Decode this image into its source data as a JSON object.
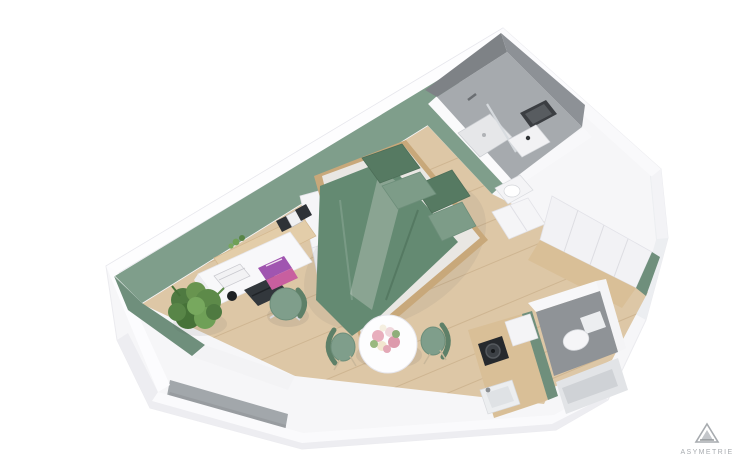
{
  "scene": {
    "type": "3d-floor-plan-render",
    "view": "isometric top-down",
    "description": "3D rendering of a studio apartment floor plan on a white background",
    "rooms": [
      {
        "name": "living-bedroom",
        "features": [
          "double bed with green bedding and four pillows",
          "white wardrobe cubes",
          "wall shelf with binders, clock and plant",
          "white desk with laptop, magazines and books",
          "green office chair",
          "floor plant",
          "round white dining table with flower bouquet",
          "two green dining chairs"
        ]
      },
      {
        "name": "bathroom",
        "features": [
          "gray concrete walls",
          "walk-in shower with glass partition",
          "washbasin with black-framed mirror",
          "toilet"
        ]
      },
      {
        "name": "separate-wc",
        "features": [
          "gray tiled floor",
          "white toilet"
        ]
      },
      {
        "name": "kitchenette",
        "features": [
          "wooden counter",
          "black cooktop",
          "inset sink with faucet",
          "white cabinet column",
          "green accent wall"
        ]
      },
      {
        "name": "entry-hall",
        "features": [
          "built-in white closets",
          "wood flooring",
          "green accent edges"
        ]
      }
    ]
  },
  "brand": {
    "name": "ASYMETRIE",
    "logo": "triangle-a-logo"
  },
  "palette": {
    "background": "#ffffff",
    "wall_white": "#f6f6f8",
    "wall_top": "#fdfdfe",
    "wall_shade": "#e9eaee",
    "accent_green": "#7f9e8b",
    "accent_green_dark": "#6f8f7c",
    "floor_wood": "#ddc7a6",
    "floor_plank": "#c8a87a",
    "concrete_wall_dark": "#7e8286",
    "concrete_wall": "#8d9196",
    "bathroom_floor": "#a6aaae",
    "wc_floor": "#8f9397",
    "window_concrete": "#a2a7ab",
    "bed_green": "#648a72",
    "bed_fold": "#8aa492",
    "pillow_dark": "#567a62",
    "pillow_light": "#7d9c88",
    "chair_green": "#7f9e8b",
    "plant_green": "#5d8a49",
    "counter_wood": "#d9bf97",
    "cooktop_black": "#26292d",
    "laptop_dark": "#32373c",
    "magazine_purple": "#a055b0",
    "magazine_pink": "#c85f9f",
    "flower_pink": "#e8aebd",
    "table_white": "#fdfdfe",
    "logo_gray": "#a8acb0"
  }
}
